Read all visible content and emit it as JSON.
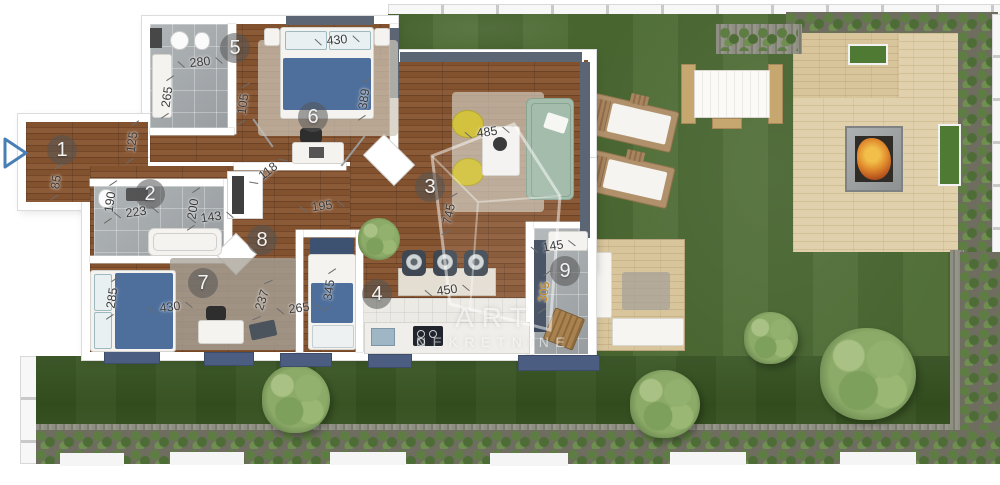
{
  "watermark": {
    "line1": "ART",
    "line2": "NEKRETNINE"
  },
  "rooms": [
    {
      "number": "1",
      "x": 62,
      "y": 150
    },
    {
      "number": "2",
      "x": 150,
      "y": 194
    },
    {
      "number": "3",
      "x": 430,
      "y": 187
    },
    {
      "number": "4",
      "x": 377,
      "y": 294
    },
    {
      "number": "5",
      "x": 235,
      "y": 48
    },
    {
      "number": "6",
      "x": 313,
      "y": 117
    },
    {
      "number": "7",
      "x": 203,
      "y": 283
    },
    {
      "number": "8",
      "x": 262,
      "y": 240
    },
    {
      "number": "9",
      "x": 565,
      "y": 271
    }
  ],
  "dimensions": [
    {
      "text": "280",
      "x": 200,
      "y": 62,
      "rot": -6
    },
    {
      "text": "265",
      "x": 167,
      "y": 97,
      "rot": -82
    },
    {
      "text": "105",
      "x": 243,
      "y": 104,
      "rot": -82
    },
    {
      "text": "430",
      "x": 337,
      "y": 40,
      "rot": -5
    },
    {
      "text": "389",
      "x": 364,
      "y": 99,
      "rot": -82
    },
    {
      "text": "125",
      "x": 132,
      "y": 142,
      "rot": -82
    },
    {
      "text": "85",
      "x": 56,
      "y": 182,
      "rot": -82
    },
    {
      "text": "190",
      "x": 110,
      "y": 202,
      "rot": -82
    },
    {
      "text": "223",
      "x": 136,
      "y": 212,
      "rot": -8
    },
    {
      "text": "200",
      "x": 193,
      "y": 209,
      "rot": -82
    },
    {
      "text": "143",
      "x": 211,
      "y": 217,
      "rot": -8
    },
    {
      "text": "118",
      "x": 268,
      "y": 171,
      "rot": -38
    },
    {
      "text": "195",
      "x": 322,
      "y": 206,
      "rot": -8
    },
    {
      "text": "485",
      "x": 487,
      "y": 132,
      "rot": -8
    },
    {
      "text": "745",
      "x": 449,
      "y": 214,
      "rot": -78
    },
    {
      "text": "450",
      "x": 447,
      "y": 290,
      "rot": -8
    },
    {
      "text": "145",
      "x": 553,
      "y": 246,
      "rot": -10
    },
    {
      "text": "305",
      "x": 544,
      "y": 292,
      "rot": -82,
      "color": "#c2871c"
    },
    {
      "text": "285",
      "x": 112,
      "y": 298,
      "rot": -82
    },
    {
      "text": "430",
      "x": 170,
      "y": 307,
      "rot": -8
    },
    {
      "text": "237",
      "x": 262,
      "y": 300,
      "rot": -72
    },
    {
      "text": "265",
      "x": 299,
      "y": 308,
      "rot": -8
    },
    {
      "text": "345",
      "x": 329,
      "y": 290,
      "rot": -82
    }
  ],
  "colors": {
    "wood": "#7d4f2c",
    "bath_tile": "#a6abae",
    "kitchen_tile": "#eceae5",
    "grass": "#4c6a33",
    "grass_dark": "#3a5527",
    "deck": "#dcc9a3",
    "hedge_green": "#5d7d42",
    "sofa_sage": "#a3bcab",
    "armchair_yellow": "#d2c23d",
    "bed_blue": "#4e6f9c",
    "awning_blue": "#4b5d80",
    "dim_text": "#3b3b3b",
    "dim_accent": "#c2871c",
    "fire_orange": "#e08a2d",
    "entrance_arrow": "#4a7fb5",
    "watermark_white": "#ffffff"
  }
}
